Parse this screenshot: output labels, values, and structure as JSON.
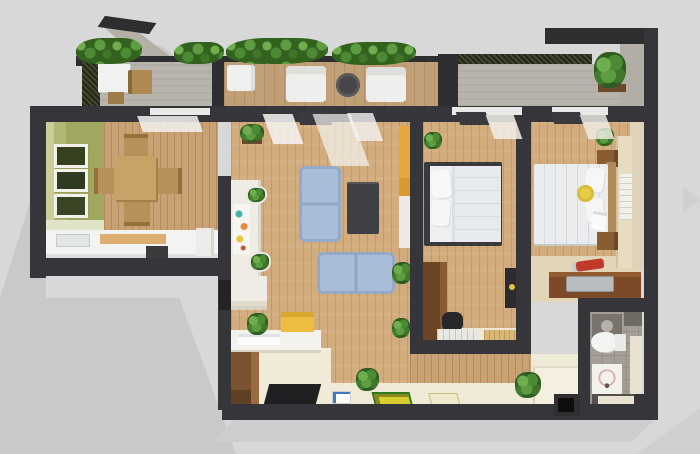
{
  "image": {
    "kind": "3d-floor-plan-render",
    "view": "top-down 3D cutaway",
    "subject": "two-bedroom apartment with balconies"
  },
  "palette": {
    "background": "#d8d8d8",
    "cast_shadow": "#c9c9c9",
    "walls": "#35353a",
    "wood_floor": "#d3ac7e",
    "balcony_concrete": "#b8b4ab",
    "accent_wall_green": "#a9b06b",
    "sofa_blue": "#a9bdd9",
    "kitchen_counter_white": "#f3f3f1",
    "vanity_wood_brown": "#7c4a26",
    "shelf_yellow": "#e5a83d",
    "plant_green": "#4c8a33",
    "hallway_cream": "#f0ead9",
    "bathroom_tile_gray": "#a49e96"
  },
  "rooms": [
    {
      "name": "Balcony terrace",
      "features": [
        "planter hedges",
        "white outdoor desk with wooden chair",
        "two white lounge chairs",
        "round dark side table",
        "wood deck"
      ]
    },
    {
      "name": "Dining room and kitchen",
      "features": [
        "olive green accent wall",
        "three framed pictures",
        "wooden dining table with four chairs",
        "white kitchen counter with sink and cooktop"
      ]
    },
    {
      "name": "Living room",
      "features": [
        "blue two-seat sofa",
        "blue loveseat",
        "dark coffee table",
        "yellow shelf unit",
        "white partition with posters and wall planters",
        "potted plants"
      ]
    },
    {
      "name": "Bedroom one",
      "features": [
        "double bed with white bedding and dark frame",
        "brown wardrobe",
        "black chair",
        "white rug",
        "tan mat",
        "leaning dark art frame",
        "corner plant"
      ]
    },
    {
      "name": "Bedroom two",
      "features": [
        "double bed with white bedding",
        "round yellow pillow",
        "two wooden nightstands",
        "beige wardrobe band",
        "white runner rug",
        "corner plant"
      ]
    },
    {
      "name": "Bathroom",
      "features": [
        "gray tile floor",
        "white toilet",
        "patterned shower mat",
        "cream ledges"
      ]
    },
    {
      "name": "Hallway and entry",
      "features": [
        "cream floor",
        "yellow doormat with green border",
        "plain doormat",
        "small white card mat",
        "black entry mat",
        "white desk with papers",
        "yellow storage box",
        "entry wardrobe",
        "three potted plants",
        "raised step platform"
      ]
    },
    {
      "name": "Upper right balcony",
      "features": [
        "concrete floor",
        "corner plant on wooden shelf",
        "dark railing"
      ]
    },
    {
      "name": "Vanity nook",
      "features": [
        "wooden vanity",
        "steel sink",
        "red faucet"
      ]
    }
  ]
}
